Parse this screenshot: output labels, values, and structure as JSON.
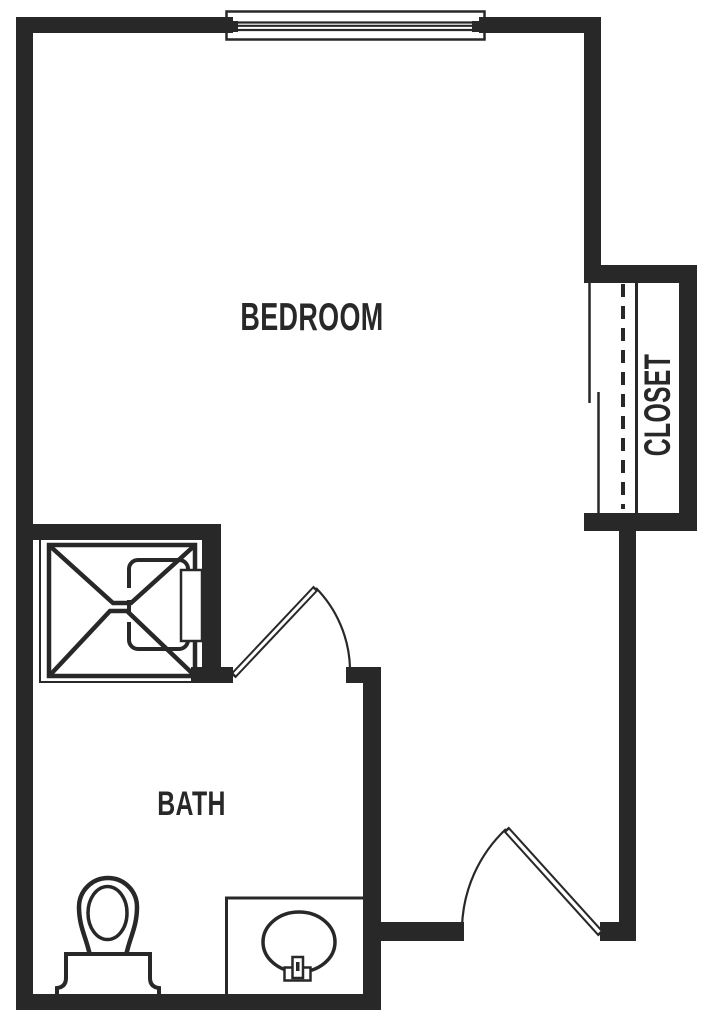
{
  "document": {
    "type": "floor-plan"
  },
  "colors": {
    "ink": "#282828",
    "paper": "#ffffff"
  },
  "rooms": {
    "bedroom": {
      "label": "BEDROOM"
    },
    "bath": {
      "label": "BATH"
    },
    "closet": {
      "label": "CLOSET"
    }
  },
  "fixtures": {
    "window": "window-with-sash",
    "shower": "shower-stall-with-fold-down-seat",
    "toilet": "toilet",
    "sink": "vanity-counter-with-oval-sink-and-faucet",
    "closet_rod": "closet-rod-dashed-line",
    "closet_shelf": "closet-shelf-line",
    "closet_doors": "bypass-sliding-doors",
    "bath_door": "hinged-swing-door",
    "entry_door": "hinged-swing-door"
  }
}
